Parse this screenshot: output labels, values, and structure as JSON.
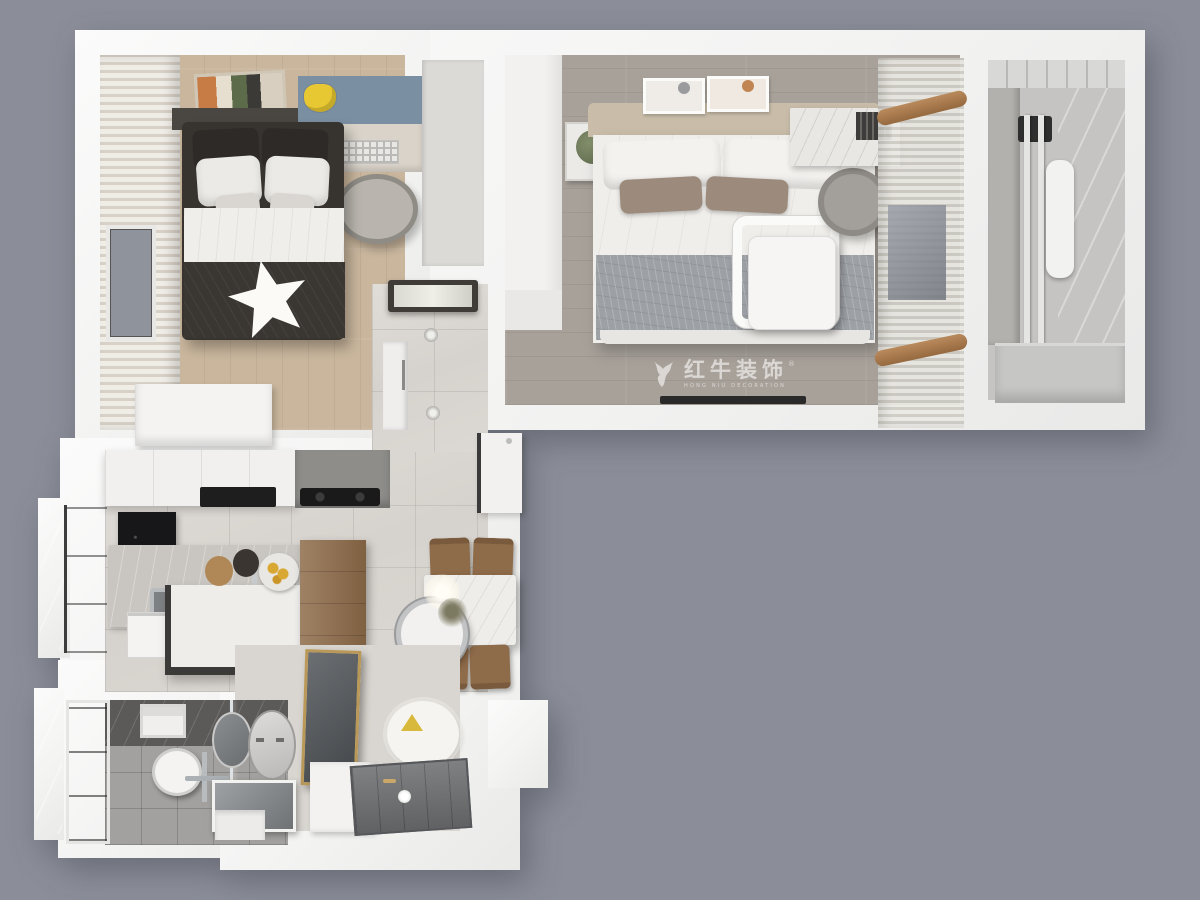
{
  "scene": {
    "type": "3d-floorplan-top-view",
    "rooms": [
      "kids-bedroom",
      "master-bedroom",
      "balcony",
      "hallway",
      "kitchen",
      "dining-area",
      "entryway",
      "bathroom"
    ]
  },
  "watermark": {
    "logo": "bull-icon",
    "registered_mark": "®",
    "title": "红牛装饰",
    "subtitle": "HONG NIU DECORATION"
  },
  "palette": {
    "bg": "#8b8e99",
    "wall": "#f5f5f4",
    "kidsFloor": "#c9b69d",
    "masterFloor": "#a8a19a",
    "tile": "#d9d5d0",
    "bathFloor": "#a3a19f",
    "bathWall": "#5c5a58",
    "blueWall": "#7b8fa2",
    "darkBed": "#37332f",
    "whiteDuvet": "#f0eeea",
    "taupePillow": "#9c8a7d",
    "grayBlanket": "#9da1a6",
    "headboard": "#c9bda9",
    "woodFurniture": "#8e6b49",
    "blackAppliance": "#1e1e1e",
    "glassBlue": "#9aa3ad",
    "watermark": "rgba(255,255,255,0.58)"
  }
}
